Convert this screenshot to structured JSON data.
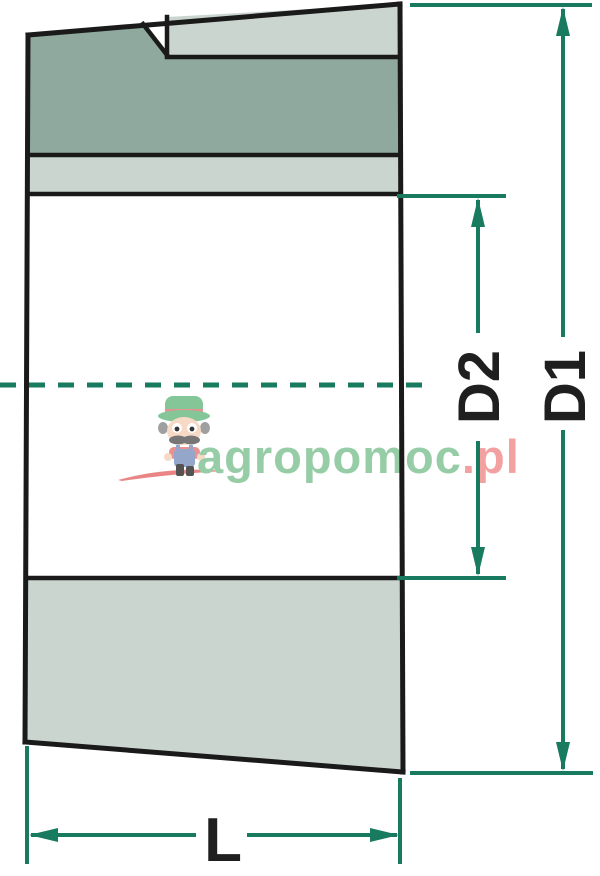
{
  "drawing": {
    "dimension_labels": {
      "outer_diameter": "D1",
      "inner_diameter": "D2",
      "length": "L"
    },
    "watermark": {
      "text_green": "agropomoc",
      "text_pink": ".pl"
    },
    "colors": {
      "outline": "#1a1a1a",
      "fill_dark_green": "#8FA99E",
      "fill_light_green": "#CBD5D0",
      "dimension_teal": "#187A5E",
      "watermark_green": "#92CBA2",
      "watermark_pink": "#F29B9B",
      "background": "#FFFFFF"
    }
  }
}
